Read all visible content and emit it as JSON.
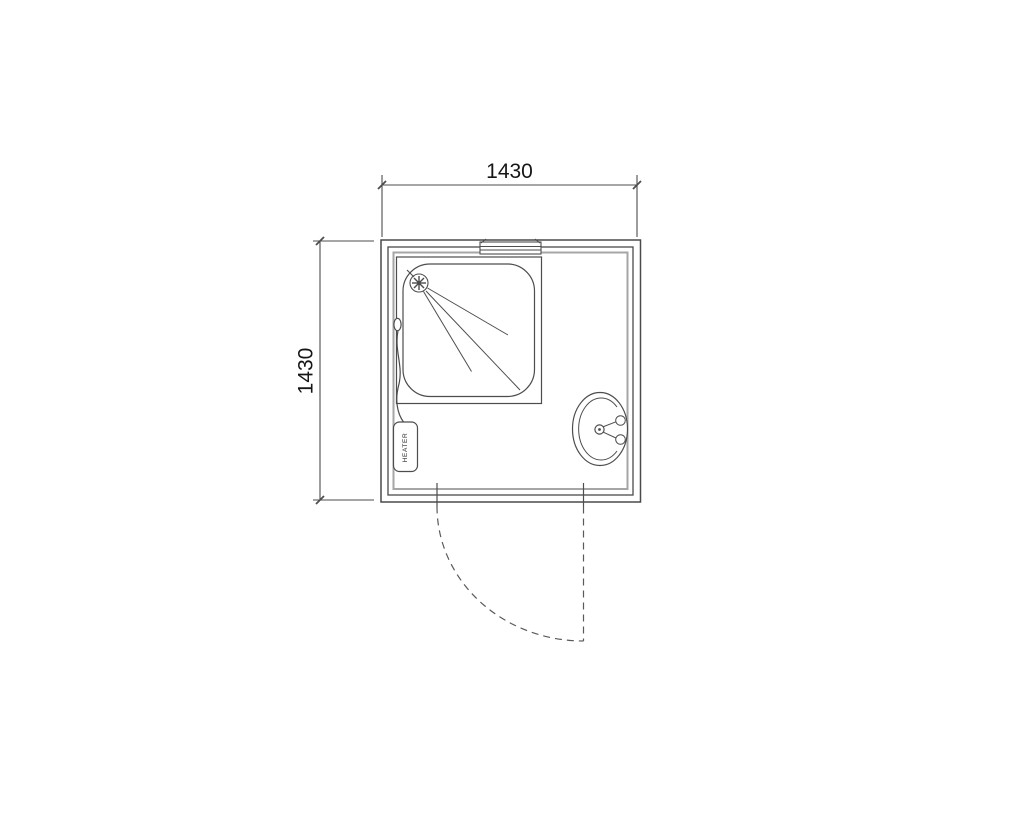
{
  "floorplan": {
    "type": "bathroom-floor-plan",
    "room": {
      "width_label": "1430",
      "depth_label": "1430",
      "width_mm": 1430,
      "depth_mm": 1430
    },
    "fixtures": {
      "shower": "shower-enclosure-with-tray-and-spray-head",
      "heater": {
        "label": "HEATER"
      },
      "basin": "wall-mounted-oval-basin-with-two-taps",
      "door": "outward-swinging-door-bottom-wall",
      "window": "window-symbol-top-wall"
    },
    "colors": {
      "line": "#4d4d4d",
      "line_light": "#a6a6a6",
      "dash": "#5a5a5a",
      "text": "#161616",
      "background": "#ffffff"
    }
  }
}
